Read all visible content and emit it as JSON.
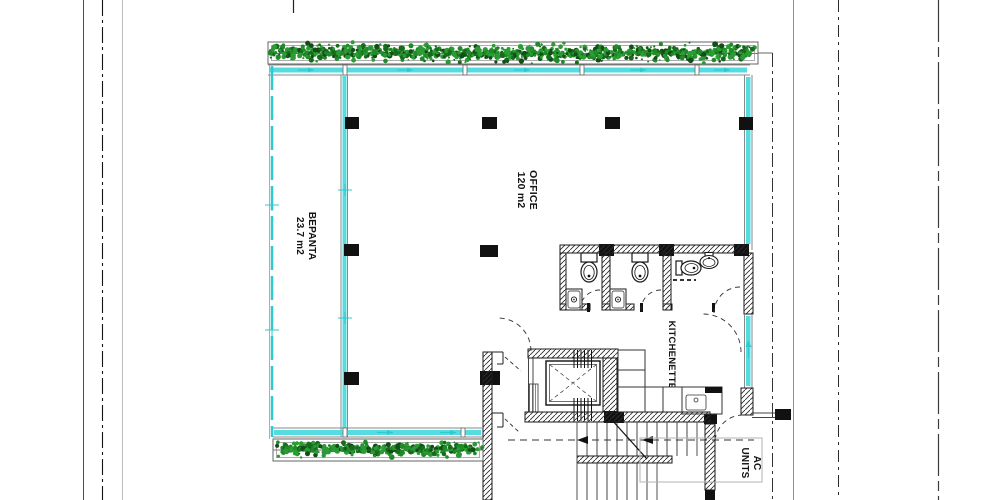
{
  "drawing": {
    "type": "architectural-floor-plan",
    "floor": "office-level"
  },
  "labels": {
    "veranda": {
      "name": "ΒΕΡΑΝΤΑ",
      "area": "23.7 m2"
    },
    "office": {
      "name": "OFFICE",
      "area": "120 m2"
    },
    "kitchenette": {
      "name": "KITCHENETTE"
    },
    "ac_units": {
      "line1": "AC",
      "line2": "UNITS"
    }
  },
  "colors": {
    "glass": "#2fc9cf",
    "glass_fill": "#55dce1",
    "wall": "#1a1a1a",
    "foliage_palette": [
      "#1f8a27",
      "#27a030",
      "#176b1d",
      "#2e9838",
      "#124f17"
    ]
  }
}
